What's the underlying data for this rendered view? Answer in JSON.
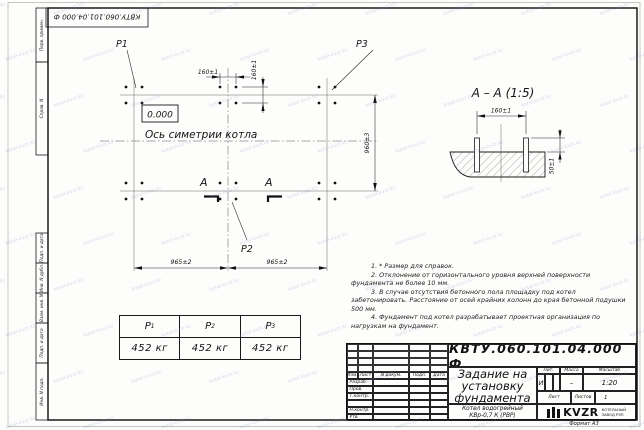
{
  "watermark": {
    "text": "kotel-kvzr.kz"
  },
  "corner_stamp": "КВТУ.060.101.04.000 Ф",
  "sidebar": {
    "items": [
      "Перв. примен.",
      "Справ. N",
      "Подп. и дата",
      "Инв. N дубл.",
      "Взам. инв. N",
      "Подп. и дата",
      "Инв. N подл."
    ]
  },
  "plan": {
    "labels": {
      "p1": "P1",
      "p2": "P2",
      "p3": "P3"
    },
    "elevation": "0.000",
    "axis_label": "Ось симетрии котла",
    "section_letter": "A",
    "dims": {
      "group_x": "160±1",
      "group_y": "160±1",
      "height": "960±3",
      "span_left": "965±2",
      "span_right": "965±2"
    }
  },
  "section": {
    "title": "A  –  A  (1:5)",
    "dims": {
      "bolt_spacing": "160±1",
      "protrusion": "50±1"
    }
  },
  "load_table": {
    "headers": [
      {
        "base": "P",
        "sub": "1"
      },
      {
        "base": "P",
        "sub": "2"
      },
      {
        "base": "P",
        "sub": "3"
      }
    ],
    "values": [
      "452 кг",
      "452 кг",
      "452 кг"
    ]
  },
  "notes": [
    "1. * Размер для справок.",
    "2. Отклонение от горизонтального уровня верхней поверхности фундамента не более 10 мм.",
    "3. В случае отсутствия бетонного пола площадку под котел забетонировать. Расстояние от осей крайних колонн до края бетонной подушки 500 мм.",
    "4. Фундамент под котел разрабатывает проектная организация по нагрузкам на фундамент."
  ],
  "title_block": {
    "doc_number": "КВТУ.060.101.04.000  Ф",
    "title_lines": [
      "Задание на",
      "установку",
      "фундамента"
    ],
    "product_lines": [
      "Котел водогрейный",
      "КВр-0,7 К  (РВР)"
    ],
    "cols": {
      "izm": "Изм.",
      "list": "Лист",
      "doc": "N докум.",
      "podp": "Подп.",
      "data": "Дата"
    },
    "rows": [
      "Разраб.",
      "Пров.",
      "Т.контр.",
      "",
      "Н.контр.",
      "Утв."
    ],
    "lit_header": "Лит.",
    "massa_header": "Масса",
    "masshtab_header": "Масштаб",
    "lit_value": "И",
    "massa_value": "–",
    "masshtab_value": "1:20",
    "sheet_label": "Лист",
    "sheets_label": "Листов",
    "sheets_value": "1",
    "logo": {
      "name": "KVZR",
      "line1": "КОТЕЛЬНЫЙ",
      "line2": "ЗАВОД РЭП"
    },
    "format_label": "Формат А3"
  }
}
